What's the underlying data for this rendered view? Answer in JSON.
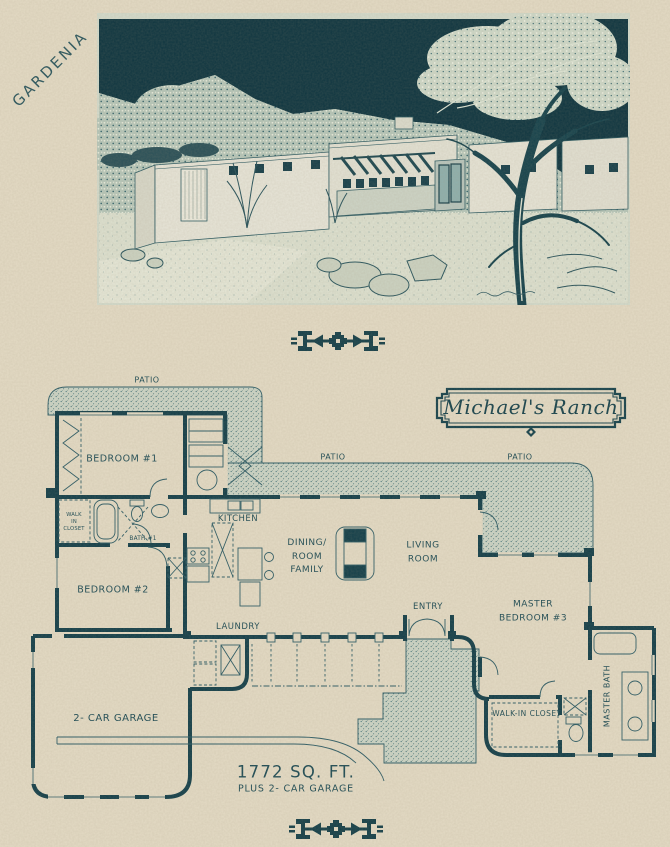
{
  "page": {
    "corner_label": "GARDENIA",
    "area_line1": "1772 SQ. FT.",
    "area_line2": "PLUS 2- CAR GARAGE"
  },
  "plan": {
    "title": "Michael's Ranch",
    "rooms": {
      "patio_top": "PATIO",
      "patio_center": "PATIO",
      "patio_right": "PATIO",
      "bedroom1": "BEDROOM #1",
      "walk_in_closet_small": "WALK\nIN\nCLOSET",
      "bath1": "BATH #1",
      "bedroom2": "BEDROOM #2",
      "kitchen": "KITCHEN",
      "dining_family": "DINING/\nROOM\nFAMILY",
      "living": "LIVING\nROOM",
      "entry": "ENTRY",
      "laundry": "LAUNDRY",
      "master_bedroom": "MASTER\nBEDROOM #3",
      "walk_in_closet": "WALK-IN CLOSET",
      "master_bath": "MASTER BATH",
      "garage": "2- CAR GARAGE"
    }
  },
  "colors": {
    "paper": "#e4dbc5",
    "ink": "#1d4b55",
    "wall": "#133f4a",
    "sky": "#0e3540",
    "patio_stipple": "#ccd5c7"
  },
  "icons": {
    "divider_top": "southwest-arrow-divider-icon",
    "divider_bottom": "southwest-arrow-divider-icon",
    "title_ornament": "diamond-ornament-icon"
  }
}
